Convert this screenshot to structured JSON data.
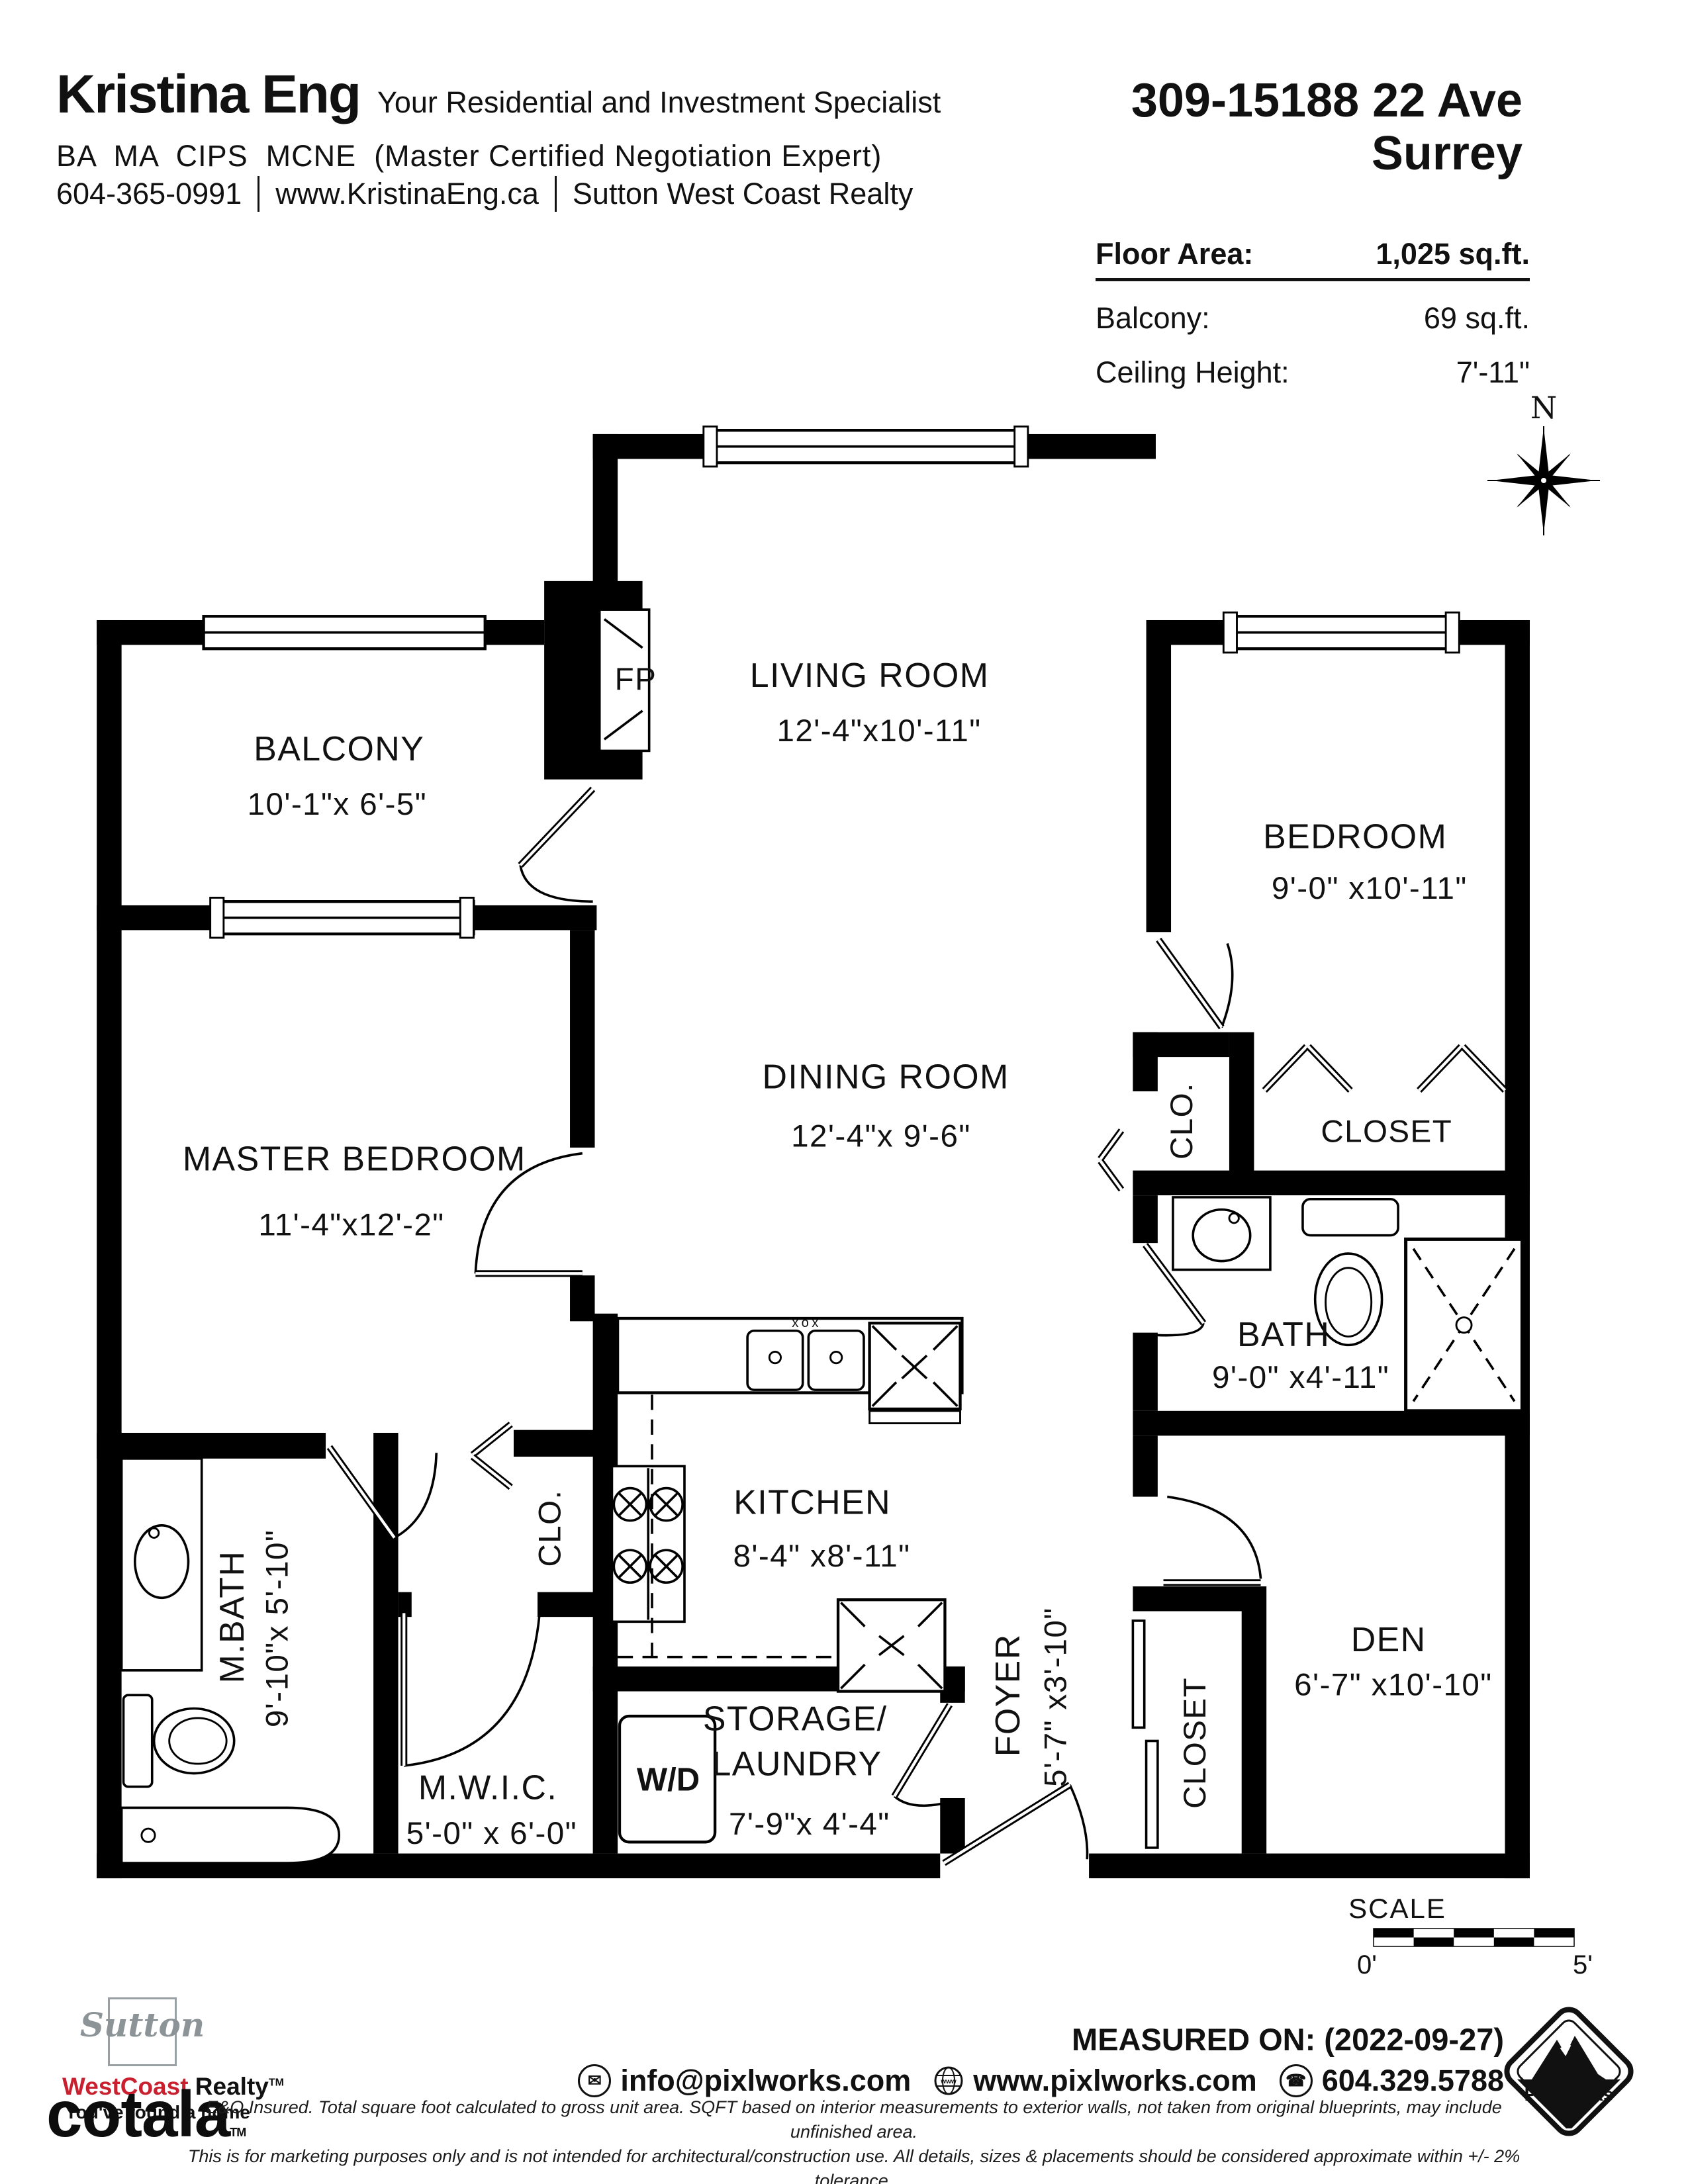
{
  "header": {
    "agent_name": "Kristina Eng",
    "tagline": "Your Residential and Investment Specialist",
    "credentials": "BA  MA  CIPS  MCNE  (Master Certified Negotiation Expert)",
    "phone": "604-365-0991",
    "website": "www.KristinaEng.ca",
    "brokerage": "Sutton West Coast Realty"
  },
  "listing": {
    "address_line1": "309-15188 22 Ave",
    "address_line2": "Surrey",
    "stats": {
      "floor_area_label": "Floor Area:",
      "floor_area_value": "1,025 sq.ft.",
      "balcony_label": "Balcony:",
      "balcony_value": "69 sq.ft.",
      "ceiling_label": "Ceiling Height:",
      "ceiling_value": "7'-11\""
    }
  },
  "compass": {
    "north_label": "N"
  },
  "rooms": {
    "living": {
      "name": "LIVING ROOM",
      "dims": "12'-4\"x10'-11\""
    },
    "balcony": {
      "name": "BALCONY",
      "dims": "10'-1\"x 6'-5\""
    },
    "bedroom": {
      "name": "BEDROOM",
      "dims": "9'-0\" x10'-11\""
    },
    "master": {
      "name": "MASTER BEDROOM",
      "dims": "11'-4\"x12'-2\""
    },
    "dining": {
      "name": "DINING ROOM",
      "dims": "12'-4\"x 9'-6\""
    },
    "kitchen": {
      "name": "KITCHEN",
      "dims": "8'-4\" x8'-11\""
    },
    "bath": {
      "name": "BATH",
      "dims": "9'-0\" x4'-11\""
    },
    "mbath": {
      "name": "M.BATH",
      "dims": "9'-10\"x 5'-10\""
    },
    "mwic": {
      "name": "M.W.I.C.",
      "dims": "5'-0\" x 6'-0\""
    },
    "storage": {
      "name_line1": "STORAGE/",
      "name_line2": "LAUNDRY",
      "dims": "7'-9\"x 4'-4\""
    },
    "foyer": {
      "name": "FOYER",
      "dims": "5'-7\" x3'-10\""
    },
    "den": {
      "name": "DEN",
      "dims": "6'-7\" x10'-10\""
    },
    "bedroom_closet": {
      "name": "CLOSET"
    },
    "foyer_closet": {
      "name": "CLOSET"
    },
    "hall_closet": {
      "name": "CLO."
    },
    "dining_closet": {
      "name": "CLO."
    },
    "fireplace": {
      "name": "FP"
    },
    "washer_dryer": {
      "name": "W/D"
    },
    "sink_faucet_mark": "xox"
  },
  "scale_bar": {
    "title": "SCALE",
    "start_label": "0'",
    "end_label": "5'"
  },
  "footer": {
    "sutton": {
      "name": "Sutton",
      "brand_red": "WestCoast",
      "brand_black": " Realty",
      "tm": "TM",
      "tagline": "You've found a home"
    },
    "cotala": {
      "name": "cotala",
      "tm": "TM"
    },
    "measured_on": "MEASURED ON: (2022-09-27)",
    "contact": {
      "email": "info@pixlworks.com",
      "website": "www.pixlworks.com",
      "phone": "604.329.5788"
    },
    "pixlworks": {
      "name": "PixlWorks",
      "stars": "★ ★ ★"
    },
    "disclaimer_line1": "E&O Insured.  Total square foot calculated to gross unit area. SQFT based on interior measurements to exterior walls, not taken from original blueprints, may include unfinished area.",
    "disclaimer_line2": "This is for marketing purposes only and is not intended for architectural/construction use.  All details, sizes & placements should be considered approximate within +/- 2%  tolerance."
  }
}
